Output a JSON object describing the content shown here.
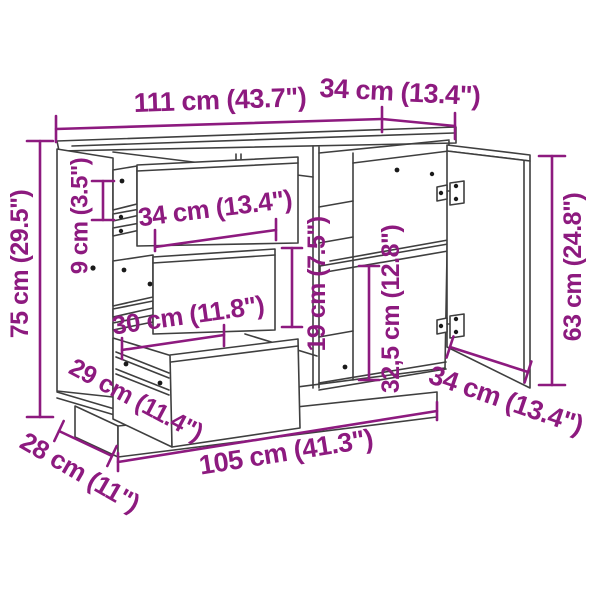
{
  "diagram_type": "furniture-dimension-drawing",
  "product": "sideboard with three drawers and one door",
  "colors": {
    "dimension_text": "#8d1a7f",
    "line_art": "#3f3f3f",
    "background": "#ffffff"
  },
  "dims": {
    "top_width": "111 cm (43.7\")",
    "top_depth": "34 cm (13.4\")",
    "height": "75 cm (29.5\")",
    "left_inner": "9 cm (3.5\")",
    "drawer_front_width": "34 cm (13.4\")",
    "drawer_inner_width": "30 cm (11.8\")",
    "middle_drawer_height": "19 cm (7.5\")",
    "lower_compartment_height": "32,5 cm (12.8\")",
    "door_height": "63 cm (24.8\")",
    "drawer_depth": "29 cm (11.4\")",
    "plinth_depth": "28 cm (11\")",
    "plinth_width": "105 cm (41.3\")",
    "door_width": "34 cm (13.4\")"
  }
}
